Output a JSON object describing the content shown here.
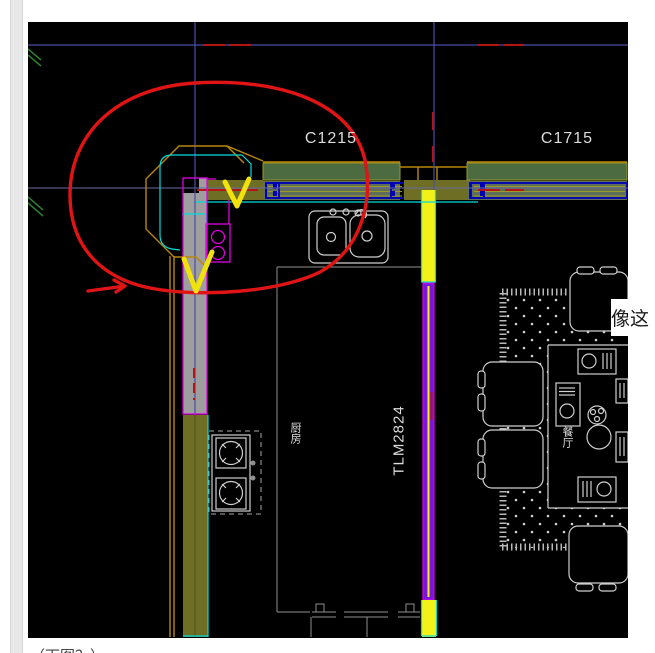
{
  "drawing_labels": {
    "window_c1215": "C1215",
    "window_c1715": "C1715",
    "door_tlm2824": "TLM2824",
    "room_kitchen": "厨房",
    "room_dining": "餐厅"
  },
  "page_text": {
    "right_margin_note": "像这",
    "bottom_caption": "（下图？）"
  },
  "colors": {
    "page_bg": "#ffffff",
    "canvas_bg": "#000000",
    "crosshair_blue": "#4d4da6",
    "cad_red": "#b41414",
    "annotation_red": "#e01414",
    "annotation_yellow": "#f0e20a",
    "gold": "#b8860b",
    "cyan": "#00dcdc",
    "magenta": "#e000e0",
    "navy": "#0000b4",
    "wall_olive": "#6e6e24",
    "window_green": "#4c6b40",
    "window_band_gray": "#5e6e58",
    "window_mullion_olive": "#9a9a28",
    "pier_yellow": "#f2f218",
    "door_purple": "#7a14e0",
    "column_gray": "#9e9e9e",
    "cad_white": "#cfcfcf",
    "kitchen_line_gray": "#909090"
  }
}
